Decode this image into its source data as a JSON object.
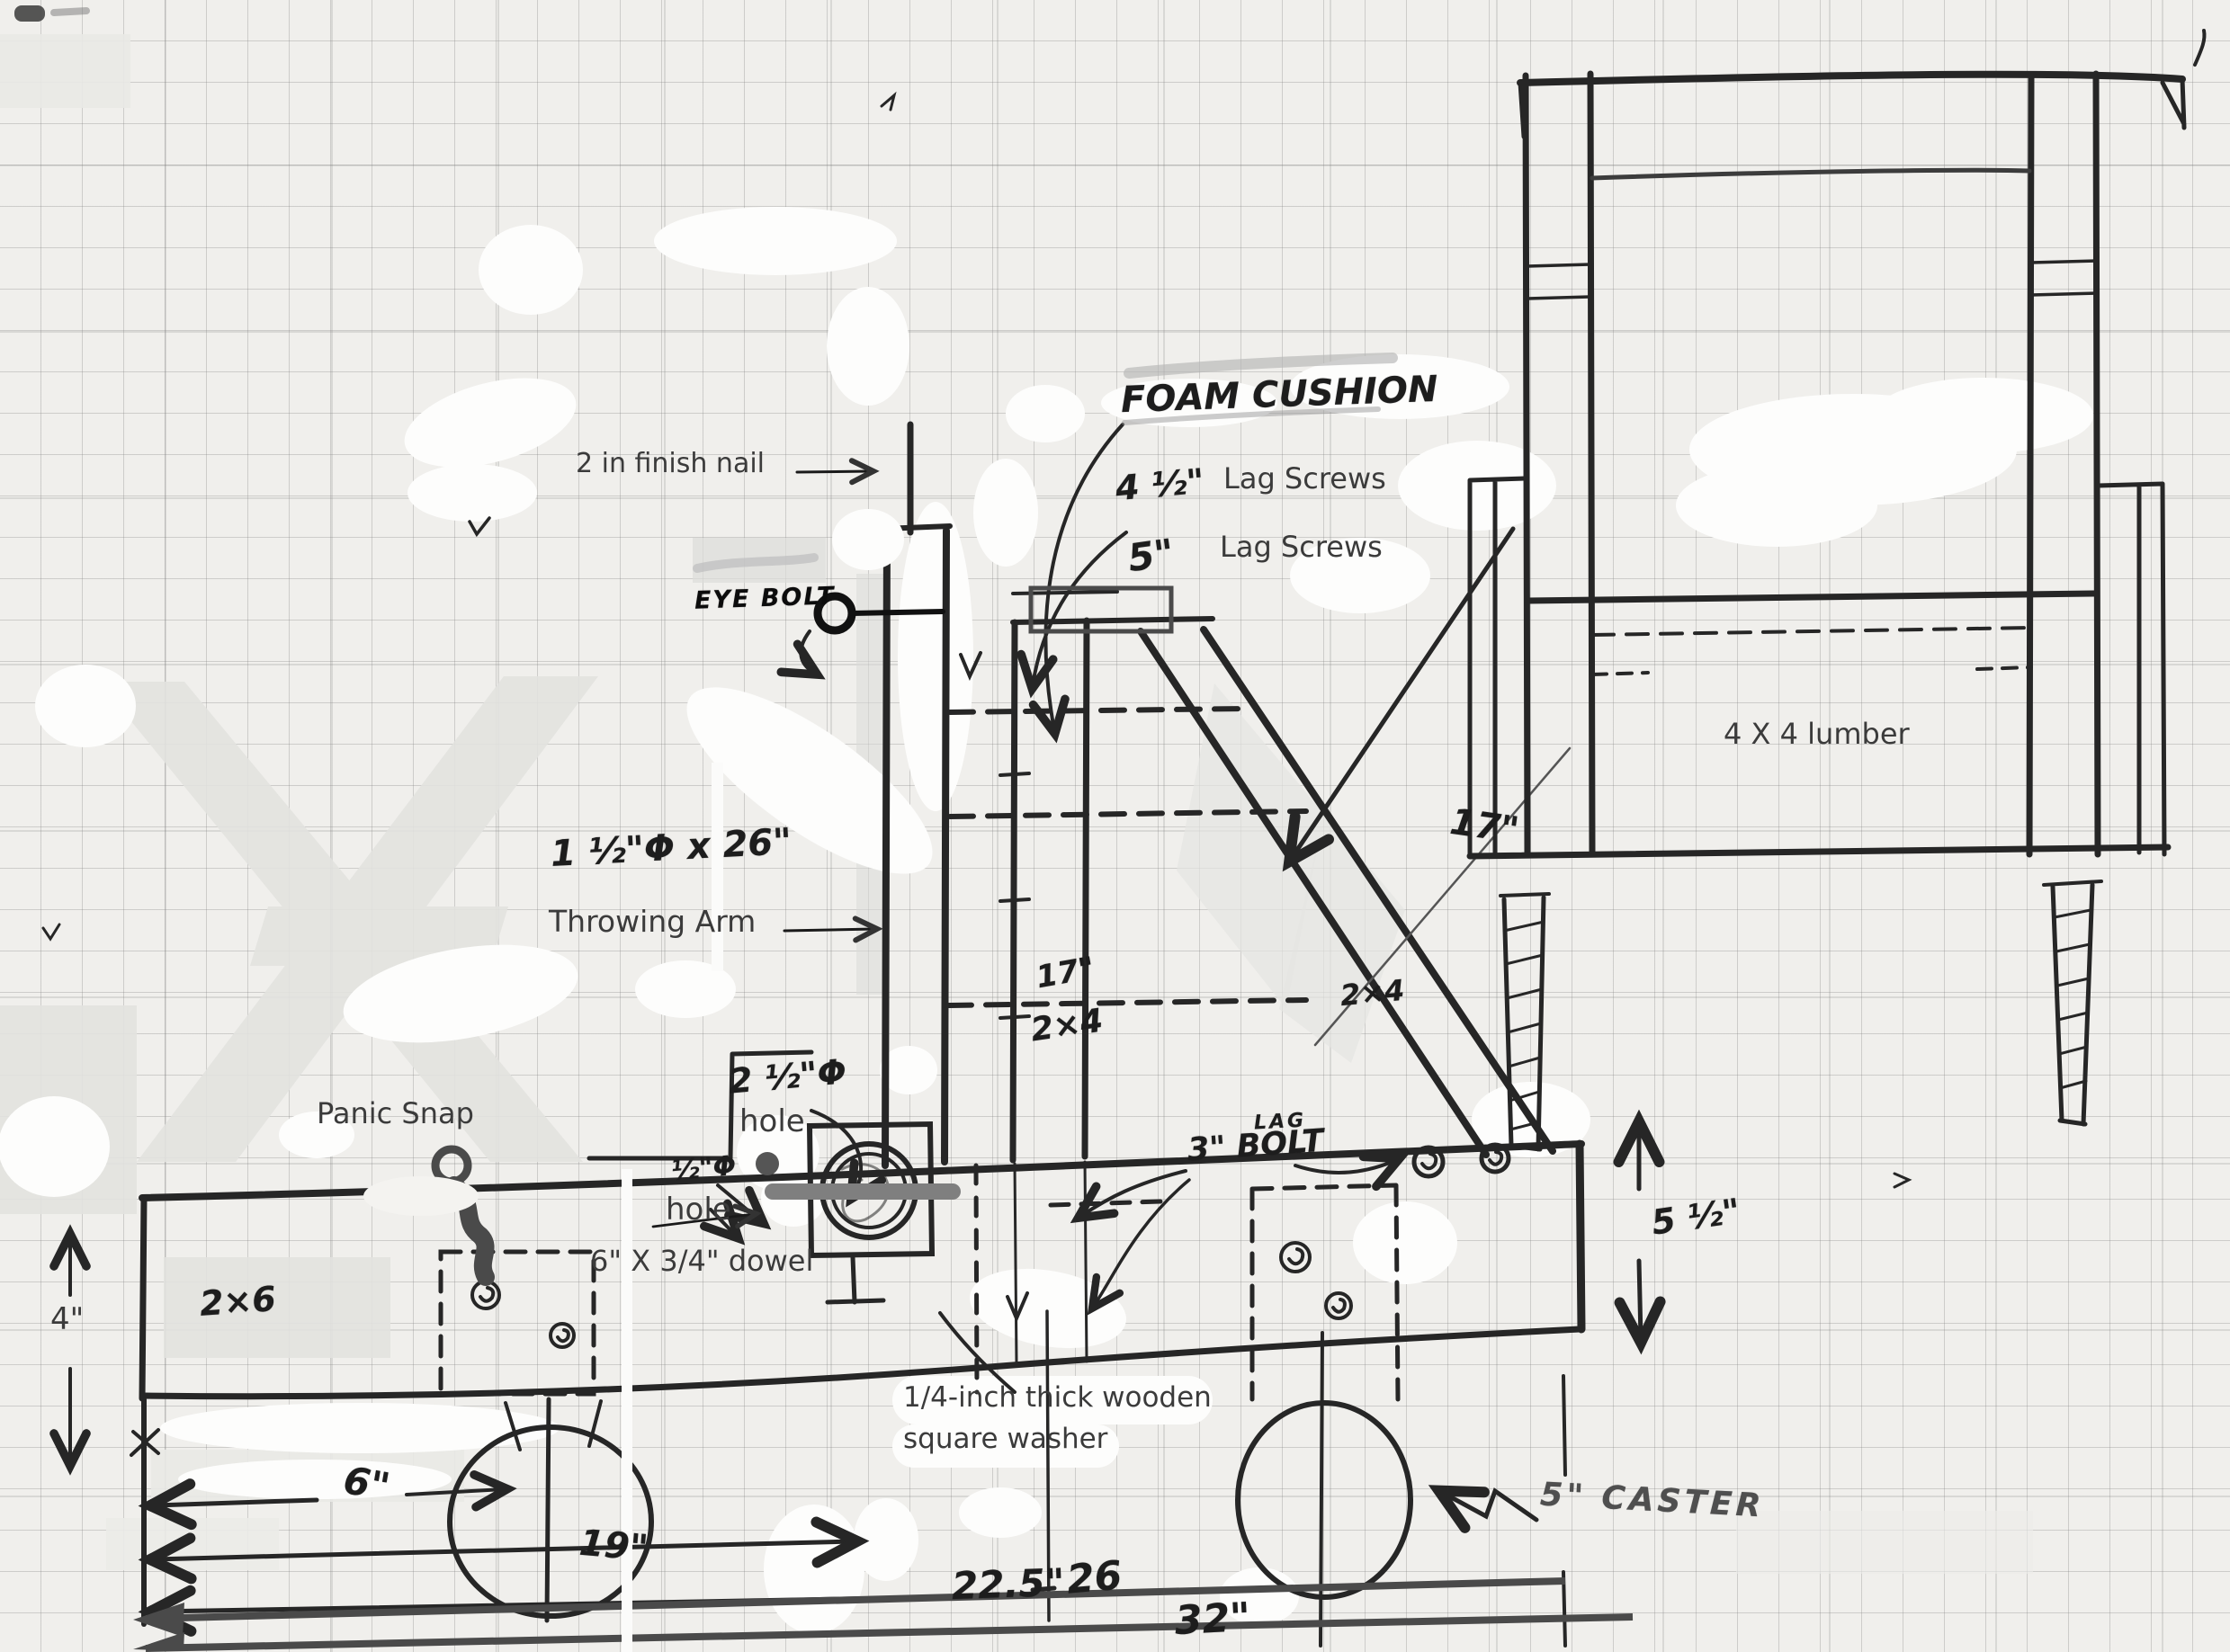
{
  "page": {
    "title": "Hand-drawn catapult / throwing-arm construction plan on graph paper"
  },
  "colors": {
    "paper": "#f0efec",
    "grid_line": "#8a8a8a",
    "pencil": "#262626",
    "digital_overlay_gray": "#4a4a4a",
    "dowel_gray": "#7f7f7f",
    "watermark_gray": "#e2e2df"
  },
  "annotations": {
    "finish_nail": "2 in finish nail",
    "foam_cushion": "FOAM CUSHION",
    "lag_screws_45_size": "4 ½\"",
    "lag_screws_45": "Lag Screws",
    "lag_screws_5_size": "5\"",
    "lag_screws_5": "Lag Screws",
    "eye_bolt": "EYE BOLT",
    "lumber_4x4": "4 X 4 lumber",
    "arm_size": "1 ½\"Φ x 26\"",
    "throwing_arm": "Throwing Arm",
    "dim_17_brace": "17\"",
    "post_17": "17\"",
    "post_2x4": "2×4",
    "brace_2x4": "2×4",
    "hole_25_size": "2 ½\"Φ",
    "hole_25_word": "hole",
    "hole_05_size": "½\"Φ",
    "hole_05_word": "hole",
    "panic_snap": "Panic Snap",
    "beam_2x6": "2×6",
    "dim_4": "4\"",
    "dowel": "6\" X 3/4\" dowel",
    "lag_bolt_small": "LAG",
    "lag_bolt_3": "3\" BOLT",
    "dim_5_half": "5 ½\"",
    "washer_line1": "1/4-inch thick wooden",
    "washer_line2": "square washer",
    "dim_6": "6\"",
    "dim_19": "19\"",
    "dim_225": "22.5\"",
    "dim_26": "26",
    "dim_32": "32\"",
    "caster": "5\" CASTER"
  }
}
